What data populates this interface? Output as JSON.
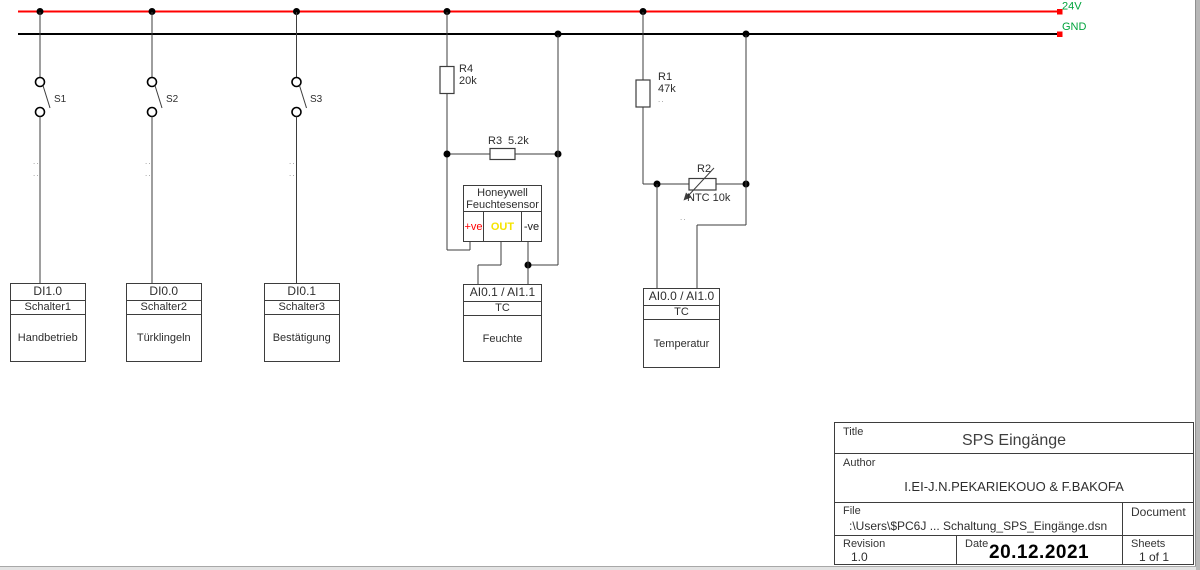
{
  "rails": {
    "v24": {
      "label": "24V",
      "wire_color": "#ff0000",
      "label_color": "#00a33c"
    },
    "gnd": {
      "label": "GND",
      "wire_color": "#000000",
      "label_color": "#00a33c"
    }
  },
  "switches": [
    {
      "ref": "S1",
      "dots": "..",
      "block": {
        "address": "DI1.0",
        "device": "Schalter1",
        "function": "Handbetrieb"
      }
    },
    {
      "ref": "S2",
      "dots": "..",
      "block": {
        "address": "DI0.0",
        "device": "Schalter2",
        "function": "Türklingeln"
      }
    },
    {
      "ref": "S3",
      "dots": "..",
      "block": {
        "address": "DI0.1",
        "device": "Schalter3",
        "function": "Bestätigung"
      }
    }
  ],
  "humidity": {
    "r4": {
      "ref": "R4",
      "value": "20k"
    },
    "r3": {
      "ref": "R3",
      "value": "5.2k"
    },
    "sensor": {
      "line1": "Honeywell",
      "line2": "Feuchtesensor",
      "pins": [
        {
          "label": "+ve",
          "color": "#ff0000"
        },
        {
          "label": "OUT",
          "color": "#f5e400"
        },
        {
          "label": "-ve",
          "color": "#1a1a1a"
        }
      ]
    },
    "block": {
      "address": "AI0.1 / AI1.1",
      "device": "TC",
      "function": "Feuchte"
    }
  },
  "temperature": {
    "r1": {
      "ref": "R1",
      "value": "47k",
      "dots": ".."
    },
    "r2": {
      "ref": "R2",
      "value": "NTC 10k",
      "dots": ".."
    },
    "block": {
      "address": "AI0.0 / AI1.0",
      "device": "TC",
      "function": "Temperatur"
    }
  },
  "title_block": {
    "title_label": "Title",
    "title": "SPS Eingänge",
    "author_label": "Author",
    "author": "I.EI-J.N.PEKARIEKOUO & F.BAKOFA",
    "file_label": "File",
    "file": ":\\Users\\$PC6J ... Schaltung_SPS_Eingänge.dsn",
    "document_label": "Document",
    "revision_label": "Revision",
    "revision": "1.0",
    "date_label": "Date",
    "date": "20.12.2021",
    "sheets_label": "Sheets",
    "sheets": "1 of 1"
  }
}
